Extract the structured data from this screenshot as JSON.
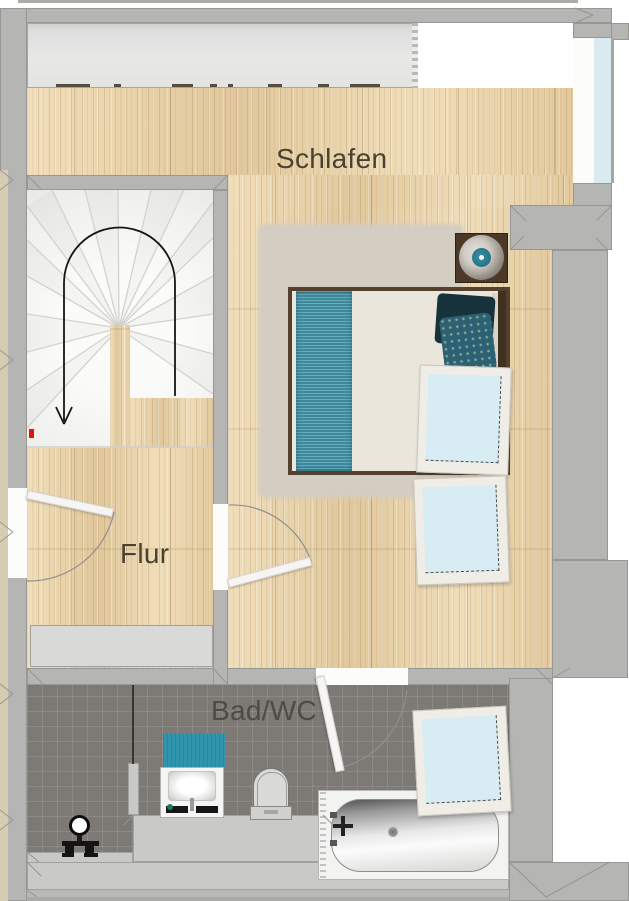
{
  "rooms": {
    "schlafen": {
      "label": "Schlafen"
    },
    "flur": {
      "label": "Flur"
    },
    "bad_wc": {
      "label": "Bad/WC"
    }
  },
  "colors": {
    "wall_gray": "#b5b5b3",
    "wood_floor": "#e7d1a8",
    "tile_floor": "#7d7a76",
    "accent_teal": "#3f93a8",
    "window_glass": "#d8ecf4",
    "rug_beige": "#d4cdc2",
    "marker_red": "#e8100c"
  },
  "icons": {
    "stairs_direction": "u-turn-arrow-down",
    "marker": "red-square",
    "lamp": "round-bedside-lamp"
  }
}
